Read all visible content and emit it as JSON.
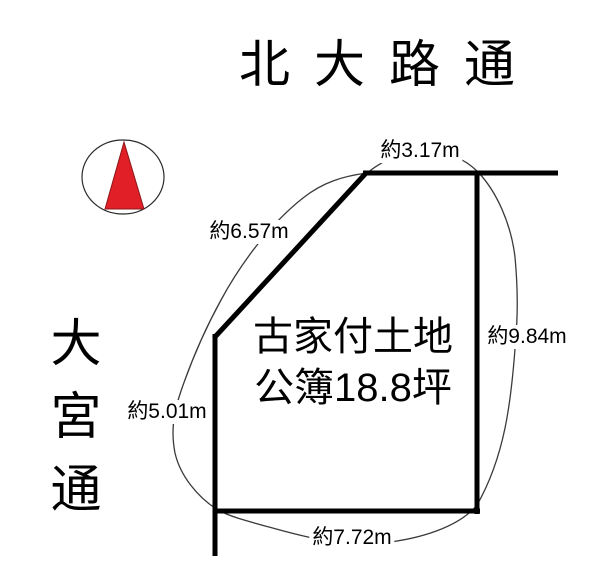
{
  "diagram": {
    "streets": {
      "top": "北大路通",
      "left": "大宮通"
    },
    "parcel": {
      "title_line1": "古家付土地",
      "title_line2": "公簿18.8坪"
    },
    "dimensions": {
      "top": "約3.17m",
      "diagonal": "約6.57m",
      "right": "約9.84m",
      "left": "約5.01m",
      "bottom": "約7.72m"
    },
    "compass": {
      "direction": "north",
      "needle_color": "#e01f26",
      "needle_stroke": "#8d171b",
      "ring_color": "#2b2b2b"
    },
    "colors": {
      "boundary_line": "#000000",
      "guide_curve": "#3a3a3a"
    }
  }
}
